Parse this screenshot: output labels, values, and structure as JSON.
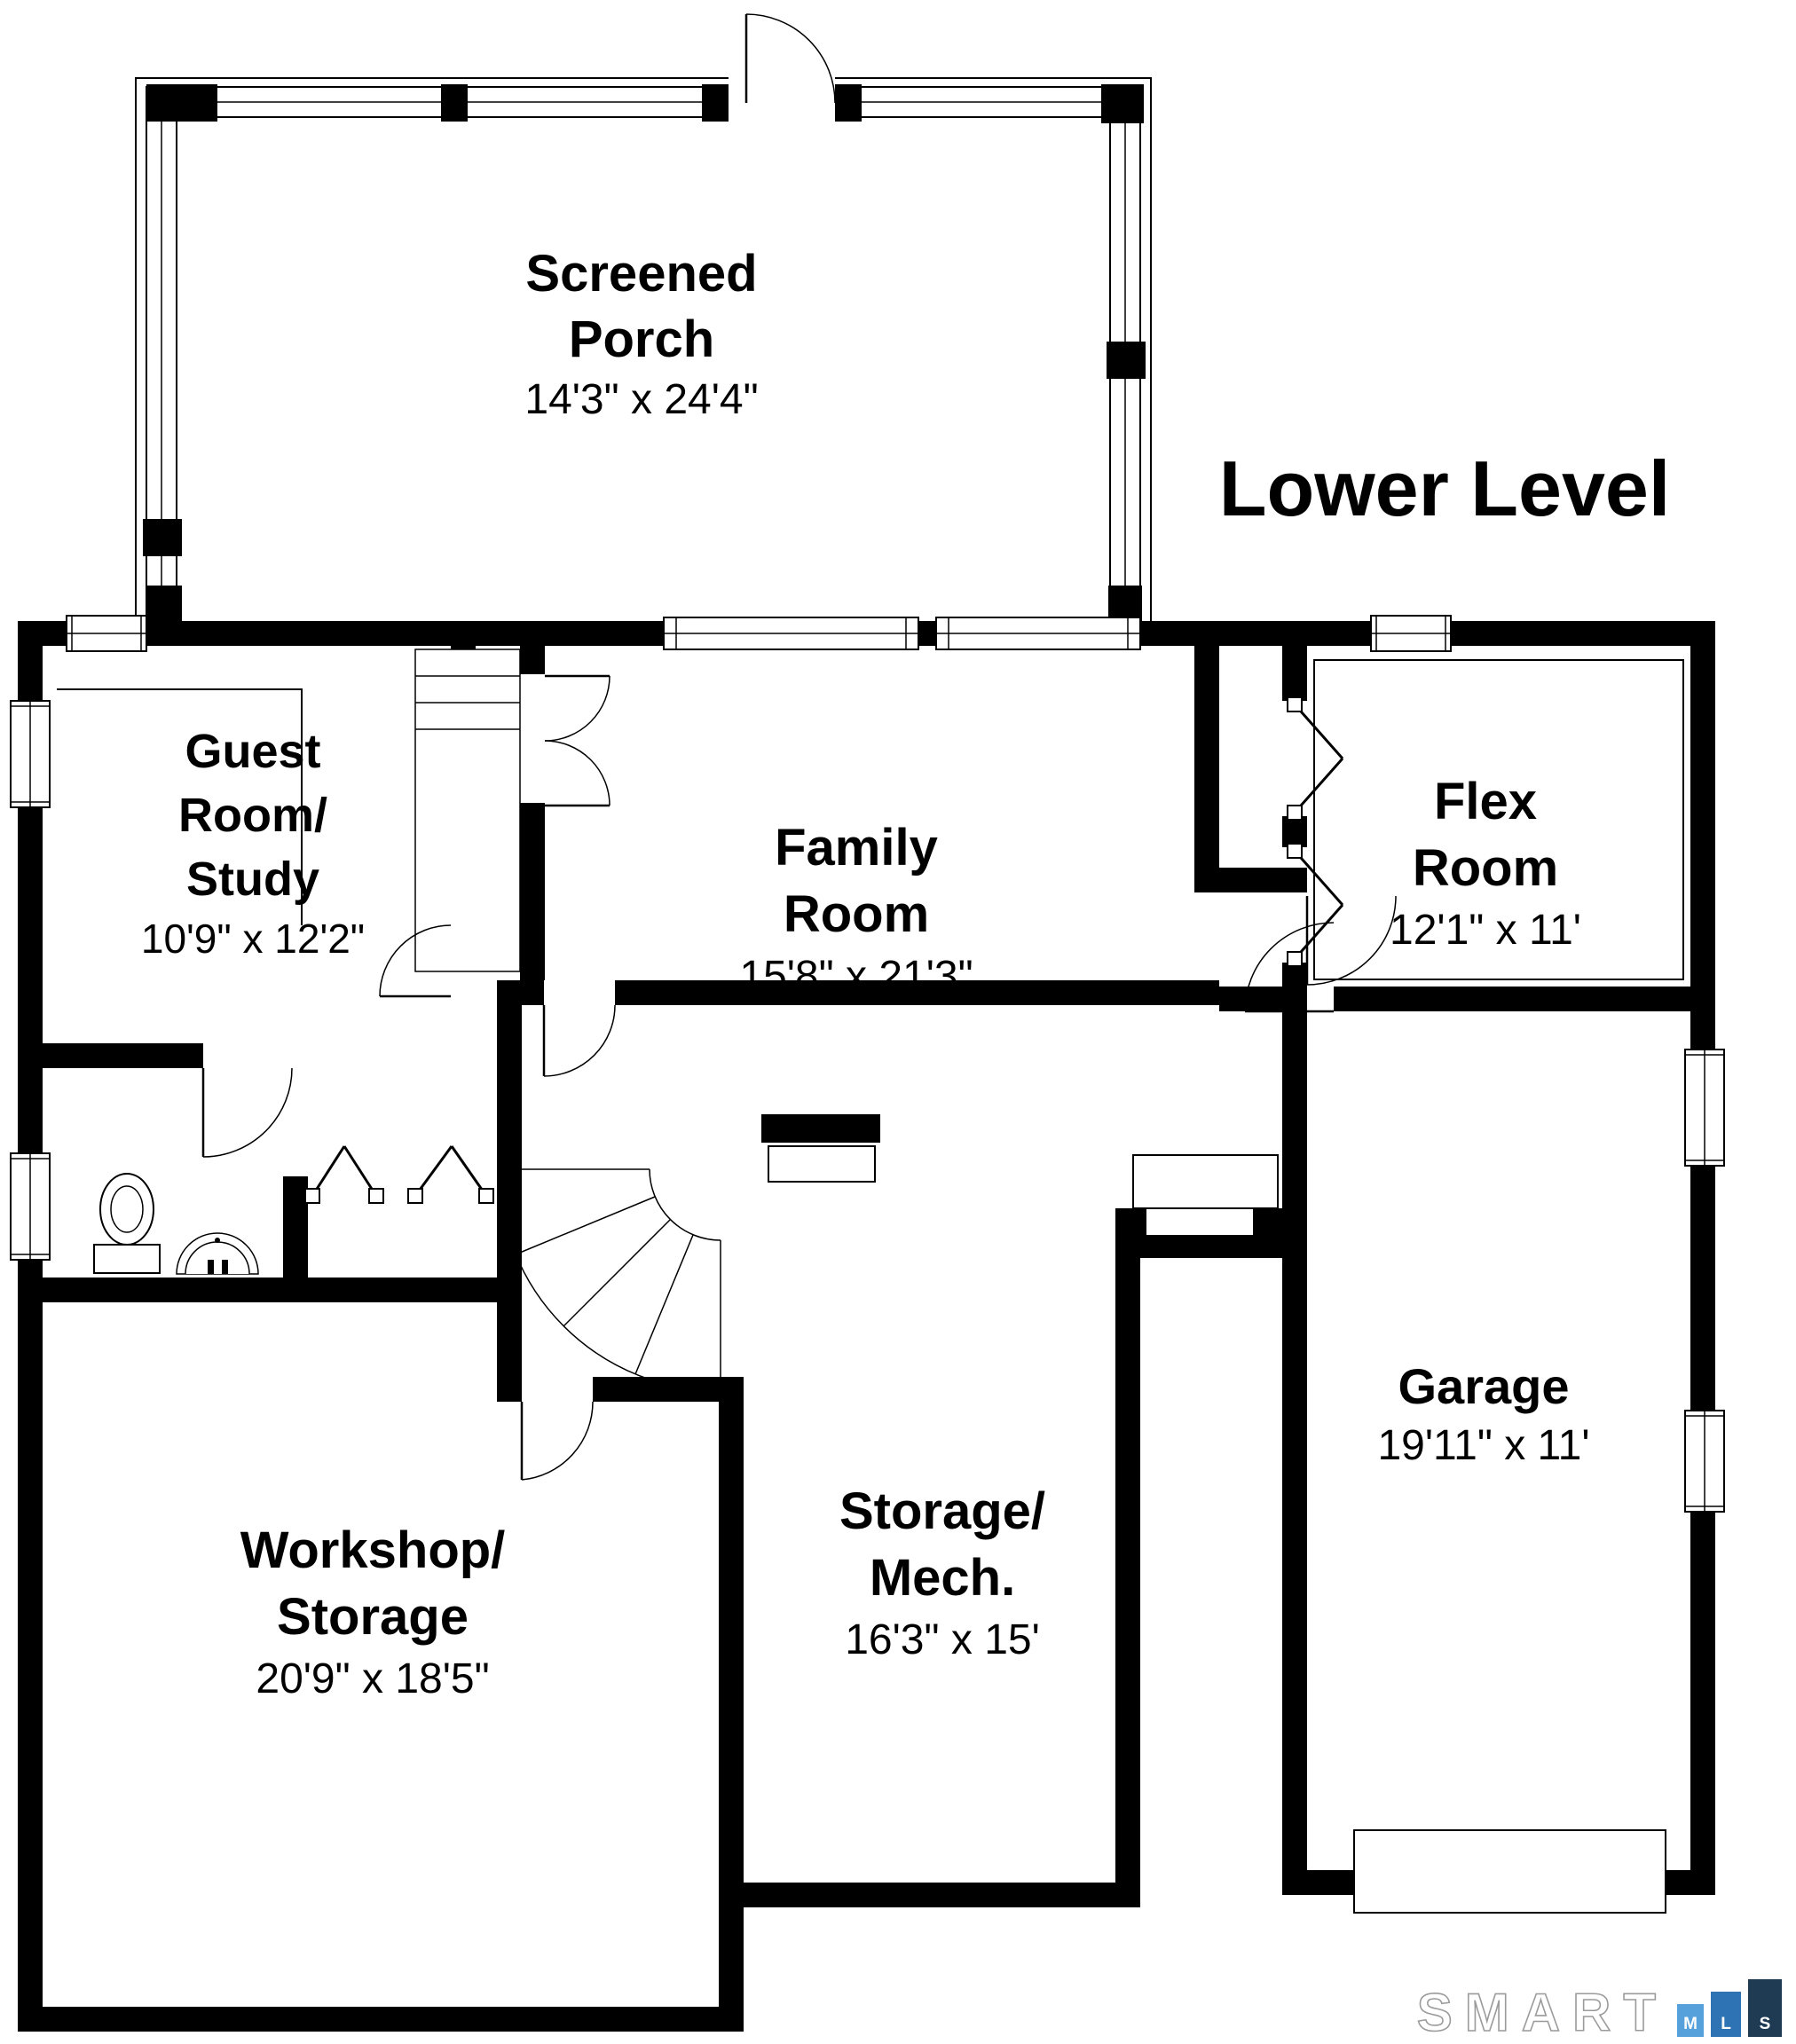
{
  "title": "Lower Level",
  "rooms": [
    {
      "id": "screened-porch",
      "name": "Screened\nPorch",
      "dims": "14'3\" x 24'4\""
    },
    {
      "id": "guest-room-study",
      "name": "Guest\nRoom/\nStudy",
      "dims": "10'9\" x 12'2\""
    },
    {
      "id": "family-room",
      "name": "Family\nRoom",
      "dims": "15'8\" x 21'3\""
    },
    {
      "id": "flex-room",
      "name": "Flex\nRoom",
      "dims": "12'1\" x 11'"
    },
    {
      "id": "workshop-storage",
      "name": "Workshop/\nStorage",
      "dims": "20'9\" x 18'5\""
    },
    {
      "id": "storage-mech",
      "name": "Storage/\nMech.",
      "dims": "16'3\" x 15'"
    },
    {
      "id": "garage",
      "name": "Garage",
      "dims": "19'11\" x 11'"
    }
  ],
  "watermark": {
    "brand": "SMART",
    "squares": [
      {
        "letter": "M",
        "color": "#56a0dc"
      },
      {
        "letter": "L",
        "color": "#2e74b5"
      },
      {
        "letter": "S",
        "color": "#1f3b54"
      }
    ],
    "outline_color": "#9b9b9b"
  },
  "colors": {
    "wall": "#000000",
    "background": "#ffffff"
  }
}
